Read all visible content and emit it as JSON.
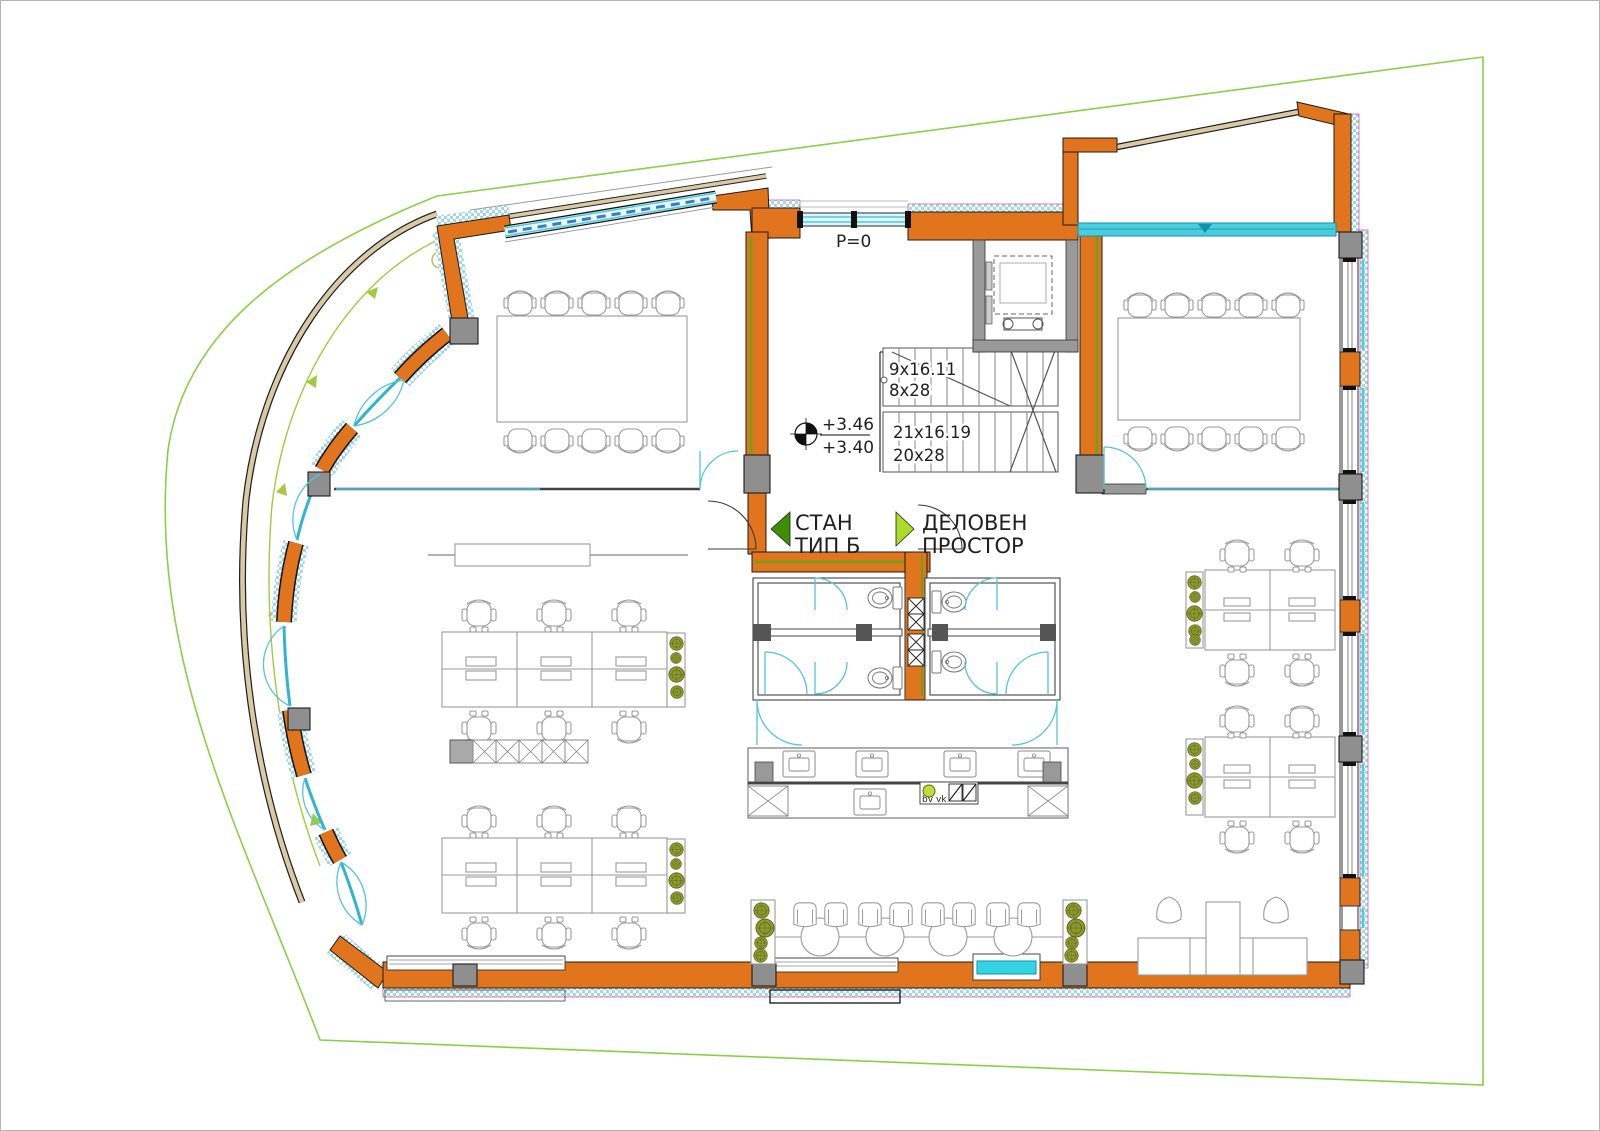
{
  "plan": {
    "entry_level_label": "P=0",
    "benchmark": {
      "upper": "+3.46",
      "lower": "+3.40"
    },
    "stairs": {
      "flight_up_a": "9x16.11",
      "flight_up_b": "8x28",
      "flight_down_a": "21x16.19",
      "flight_down_b": "20x28"
    },
    "rooms": {
      "apartment": {
        "line1": "СТАН",
        "line2": "ТИП Б"
      },
      "office": {
        "line1": "ДЕЛОВЕН",
        "line2": "ПРОСТОР"
      }
    },
    "kitchen_notes": {
      "a": "bv",
      "b": "vk"
    },
    "colors": {
      "wall": "#e0751d",
      "insulation": "#9fd8ea",
      "insulation_edge": "#d4459f",
      "glazing": "#49ccdc",
      "glazing_dark": "#0d93ad",
      "boundary": "#8ccf45",
      "railing": "#d9c9a4",
      "column": "#8f8f8f",
      "plant": "#8f9a2e",
      "arrow_apartment": "#3f8f06",
      "arrow_office": "#a9dc2a",
      "text": "#1f1f1f"
    }
  }
}
